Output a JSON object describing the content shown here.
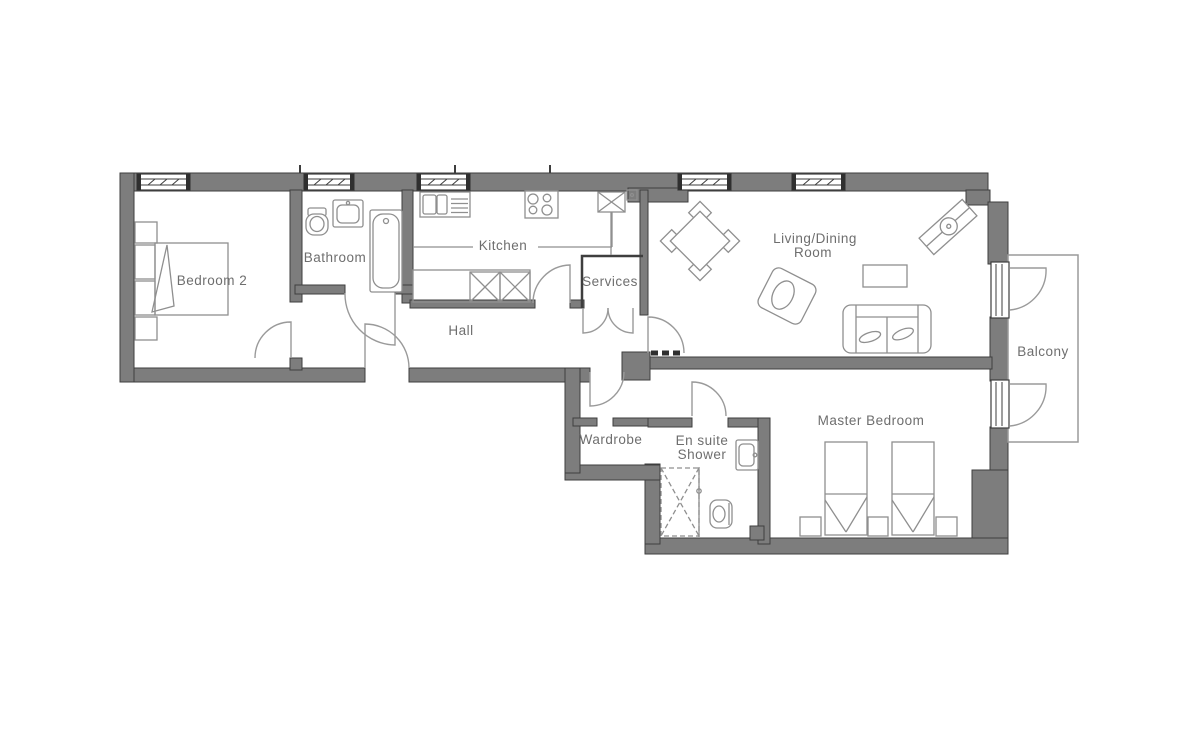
{
  "palette": {
    "wall_fill": "#7d7d7d",
    "wall_outline": "#3e3e3e",
    "furniture_line": "#8f8f8f",
    "label_text": "#6e6e6e",
    "background": "#ffffff"
  },
  "rooms": {
    "bedroom2": {
      "label": "Bedroom 2"
    },
    "bathroom": {
      "label": "Bathroom"
    },
    "kitchen": {
      "label": "Kitchen"
    },
    "hall": {
      "label": "Hall"
    },
    "services": {
      "label": "Services"
    },
    "living_dining": {
      "label_line1": "Living/Dining",
      "label_line2": "Room"
    },
    "balcony": {
      "label": "Balcony"
    },
    "wardrobe": {
      "label": "Wardrobe"
    },
    "ensuite": {
      "label_line1": "En suite",
      "label_line2": "Shower"
    },
    "master_bedroom": {
      "label": "Master Bedroom"
    }
  },
  "fixtures": [
    "double-bed",
    "wardrobe-units",
    "toilet",
    "basin",
    "bathtub",
    "kitchen-sink",
    "hob",
    "counter-units",
    "dining-table-chairs",
    "armchair",
    "sofa",
    "coffee-table",
    "tv-unit",
    "shower-tray",
    "twin-beds",
    "bedside-tables",
    "balcony-doors",
    "windows"
  ]
}
